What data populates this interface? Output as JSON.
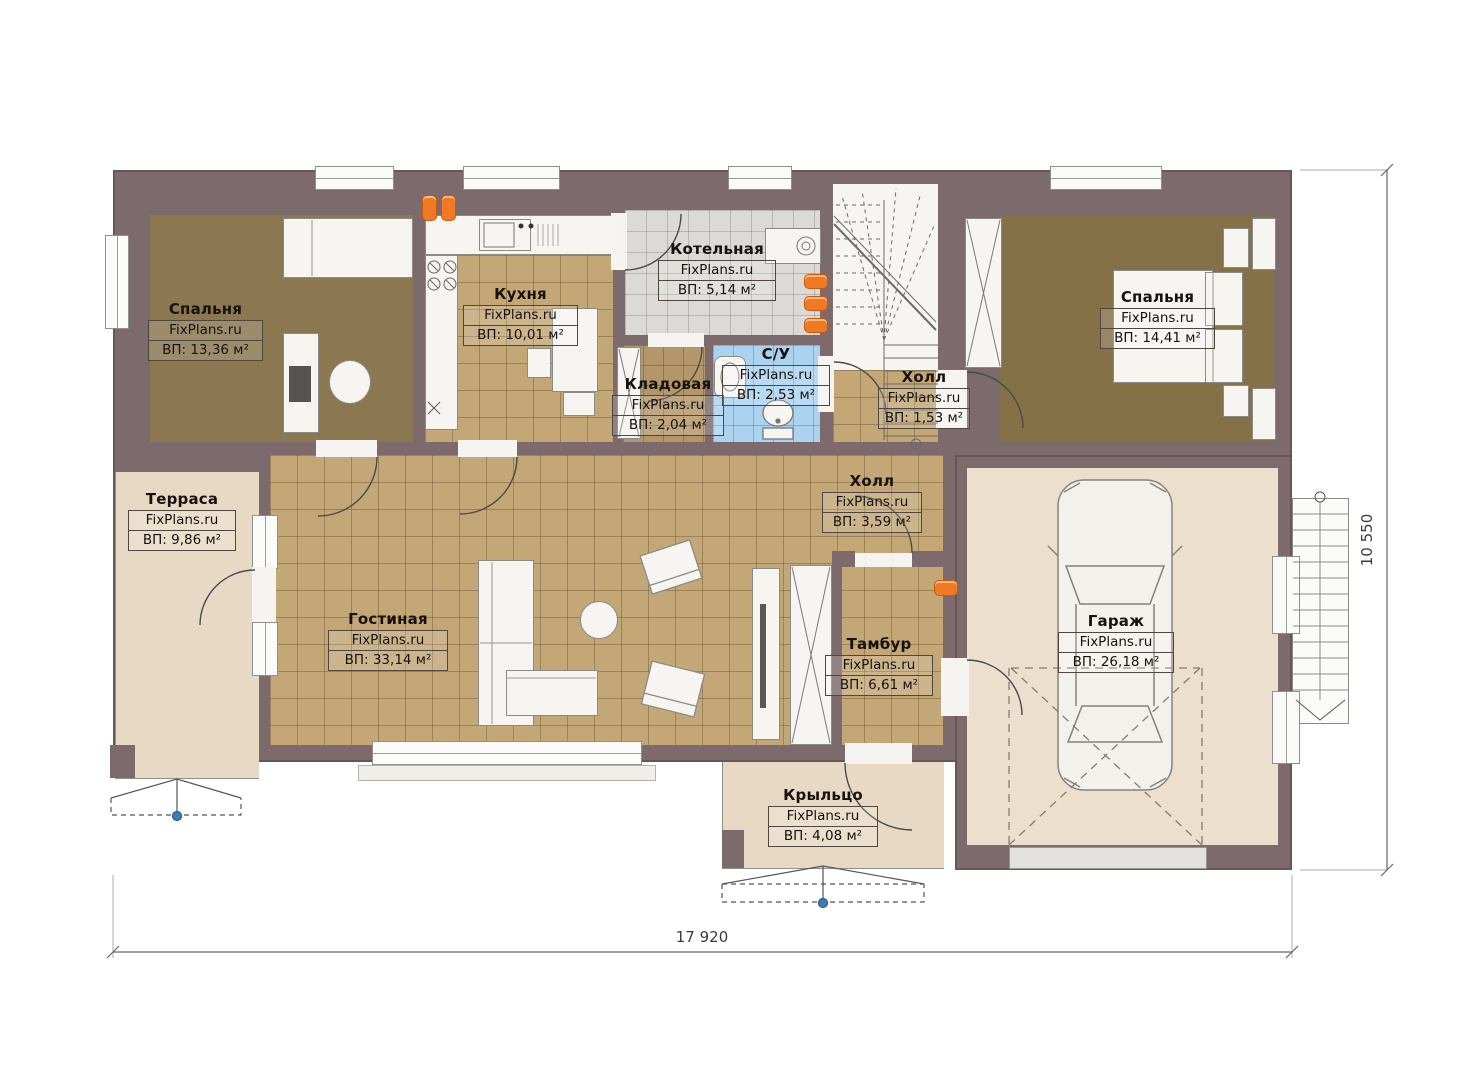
{
  "site": "FixPlans.ru",
  "plan_title": "План 1 этажа",
  "rooms": [
    {
      "name": "Спальня",
      "area": "ВП: 13,36 м²"
    },
    {
      "name": "Кухня",
      "area": "ВП: 10,01 м²"
    },
    {
      "name": "Котельная",
      "area": "ВП: 5,14 м²"
    },
    {
      "name": "Кладовая",
      "area": "ВП: 2,04 м²"
    },
    {
      "name": "С/У",
      "area": "ВП: 2,53 м²"
    },
    {
      "name": "Холл",
      "area": "ВП: 1,53 м²"
    },
    {
      "name": "Спальня",
      "area": "ВП: 14,41 м²"
    },
    {
      "name": "Терраса",
      "area": "ВП: 9,86 м²"
    },
    {
      "name": "Холл",
      "area": "ВП: 3,59 м²"
    },
    {
      "name": "Гостиная",
      "area": "ВП: 33,14 м²"
    },
    {
      "name": "Тамбур",
      "area": "ВП: 6,61 м²"
    },
    {
      "name": "Гараж",
      "area": "ВП: 26,18 м²"
    },
    {
      "name": "Крыльцо",
      "area": "ВП: 4,08 м²"
    }
  ],
  "dimensions": {
    "width_mm": "17 920",
    "height_mm": "10 550"
  },
  "colors": {
    "wall": "#7d6a6c",
    "tile_floor": "#c3a776",
    "bedroom_floor": "#8b7750",
    "boiler_floor": "#dbdad7",
    "bathroom_floor": "#abd3f0",
    "terrace_floor": "#e8d9c5",
    "garage_floor": "#ecdfcd",
    "furniture": "#f6f5f2",
    "radiator": "#f07a23",
    "marker_blue": "#3e7cb6"
  }
}
